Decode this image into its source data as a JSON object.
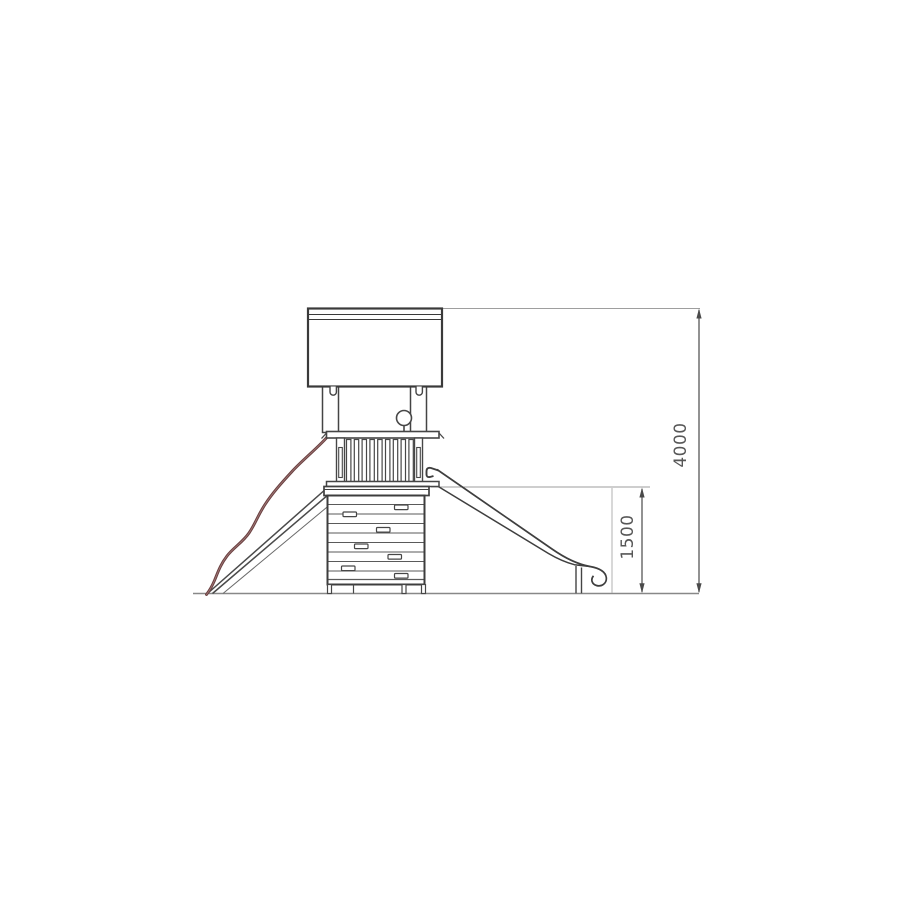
{
  "page": {
    "background": "#ffffff"
  },
  "drawing": {
    "subject": "Playground tower with slide — side elevation line drawing",
    "colors": {
      "structure_line": "#3f3f3f",
      "plank_line": "#5a5a5a",
      "extension_line": "#9e9e9e",
      "ground_line": "#888888",
      "dimension_line": "#4a4a4a",
      "dimension_text": "#575757",
      "rope": "#6a4141",
      "rope_highlight": "#a07676",
      "background": "#ffffff"
    },
    "dimensions": {
      "total_height": {
        "label": "4000",
        "orientation": "vertical"
      },
      "platform_height": {
        "label": "1500",
        "orientation": "vertical"
      }
    },
    "components": [
      "roof",
      "roof-hooks",
      "tower-posts",
      "ball-finial",
      "railing-with-balusters",
      "platform-deck",
      "climbing-wall-panel",
      "climbing-holds",
      "climbing-ramp",
      "climbing-rope",
      "slide",
      "slide-support-leg",
      "ground-line"
    ]
  }
}
